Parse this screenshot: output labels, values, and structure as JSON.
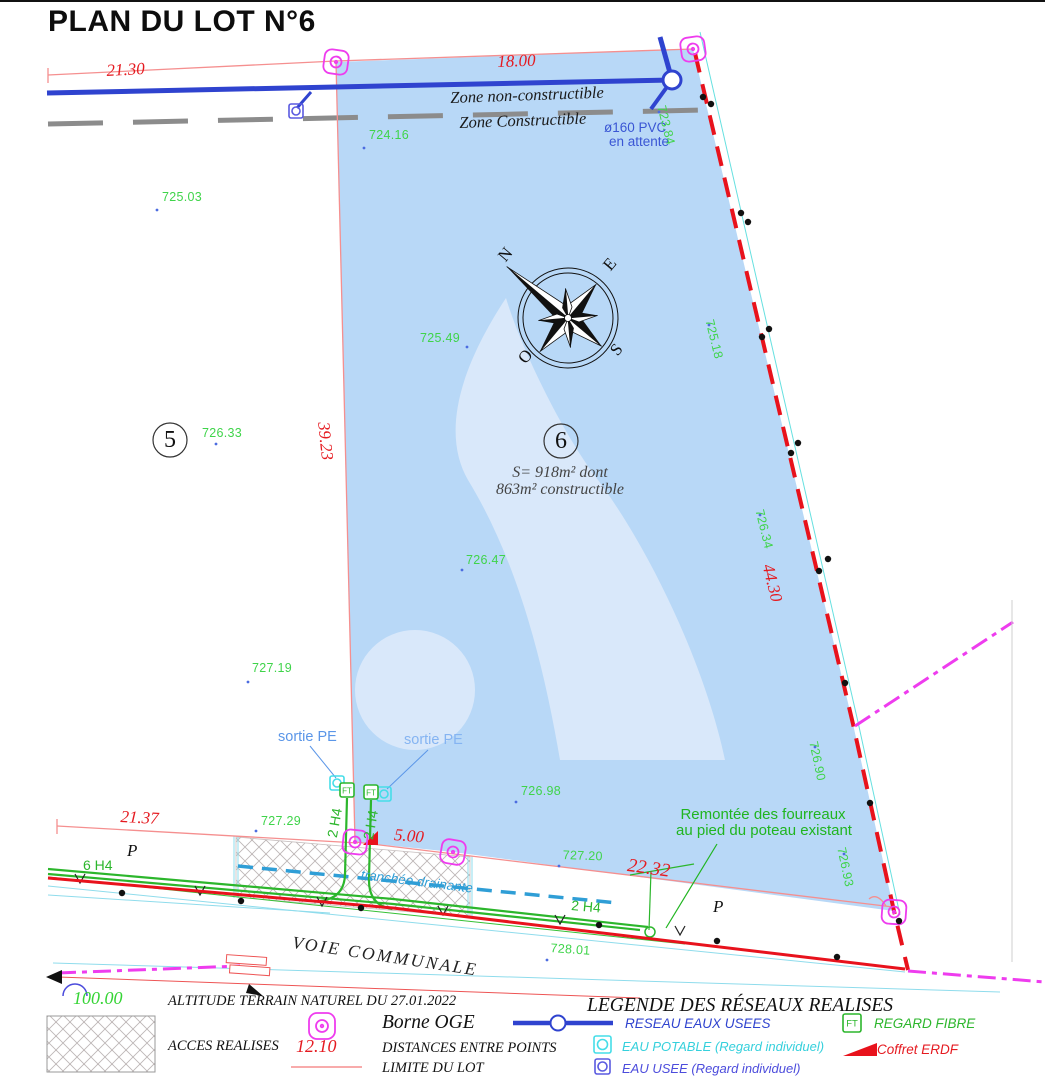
{
  "title": "PLAN DU LOT N°6",
  "colors": {
    "lot_fill": "#b8d8f7",
    "watermark": "#d9e8fa",
    "boundary_red": "#e8121c",
    "limit_red_thin": "#f58f8f",
    "measure_red": "#e51a20",
    "elevation_green": "#3fd44a",
    "fibre_green": "#2cb62c",
    "sewer_blue": "#2f43cf",
    "water_cyan": "#45dde8",
    "borne_magenta": "#ee3cee",
    "zone_gray": "#8c8c8c",
    "tranchee_blue": "#2f9ed6"
  },
  "lot6": {
    "number": "6",
    "area_line1": "S= 918m²  dont",
    "area_line2": "863m² constructible"
  },
  "lot5": {
    "number": "5"
  },
  "compass": {
    "n": "N",
    "e": "E",
    "s": "S",
    "o": "O"
  },
  "zones": {
    "non_constructible": "Zone non-constructible",
    "constructible": "Zone Constructible"
  },
  "measurements": {
    "top_left": "21.30",
    "top": "18.00",
    "left": "39.23",
    "right": "44.30",
    "bottom_left": "21.37",
    "access": "5.00",
    "road": "22.32"
  },
  "elevations": [
    "724.16",
    "725.03",
    "725.49",
    "726.33",
    "726.47",
    "727.19",
    "727.29",
    "726.98",
    "727.20",
    "728.01",
    "723.84",
    "725.18",
    "726.34",
    "726.90",
    "726.93"
  ],
  "annotations": {
    "pvc_line1": "ø160 PVC",
    "pvc_line2": "en attente",
    "sortie_pe": "sortie PE",
    "tranchee": "tranchée drainante",
    "remontee_line1": "Remontée des fourreaux",
    "remontee_line2": "au pied du poteau existant",
    "voie": "VOIE COMMUNALE",
    "parcel_letter": "P",
    "hedge_6": "6 H4",
    "conduit_2": "2 H4"
  },
  "legend": {
    "title": "LEGENDE DES RÉSEAUX REALISES",
    "altitude_value": "100.00",
    "altitude_label": "ALTITUDE TERRAIN NATUREL DU 27.01.2022",
    "acces_label": "ACCES REALISES",
    "borne_label": "Borne OGE",
    "distance_value": "12.10",
    "distance_label": "DISTANCES ENTRE POINTS",
    "limite_label": "LIMITE DU LOT",
    "reseau_label": "RESEAU EAUX USEES",
    "potable_label": "EAU POTABLE (Regard individuel)",
    "usee_label": "EAU USEE (Regard individuel)",
    "fibre_label": "REGARD FIBRE",
    "erdf_label": "Coffret ERDF",
    "ft": "FT"
  }
}
